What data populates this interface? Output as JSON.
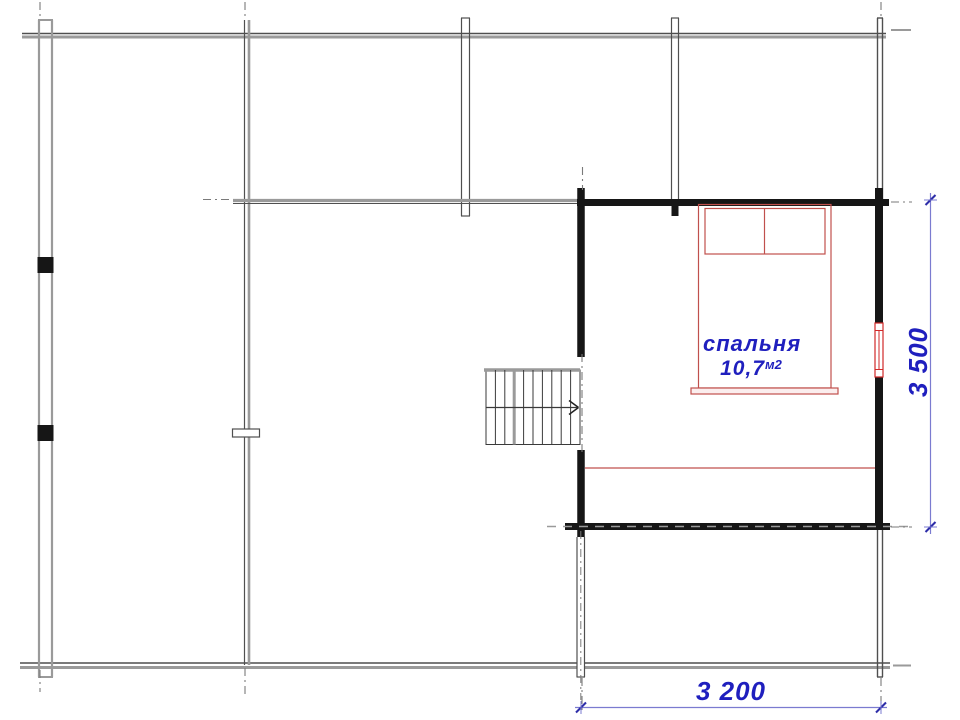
{
  "colors": {
    "background": "#ffffff",
    "wall_gray": "#9a9a9a",
    "wall_dark": "#4f4f4f",
    "structure_black": "#161616",
    "stair_line": "#3a3a3a",
    "furniture_red": "#c0504d",
    "window_red": "#d02828",
    "axis_gray": "#7a7a7a",
    "dimension_line_blue": "#7b7bd0",
    "dimension_tick_blue": "#2d2da8",
    "text_blue": "#1f1fbe"
  },
  "rooms": [
    {
      "name": "спальня",
      "area_value": "10,7",
      "area_unit": "м2"
    }
  ],
  "dimensions": [
    {
      "label": "3 200",
      "orientation": "horizontal"
    },
    {
      "label": "3 500",
      "orientation": "vertical"
    }
  ],
  "icons": {
    "stairs_direction_arrow": "›"
  }
}
